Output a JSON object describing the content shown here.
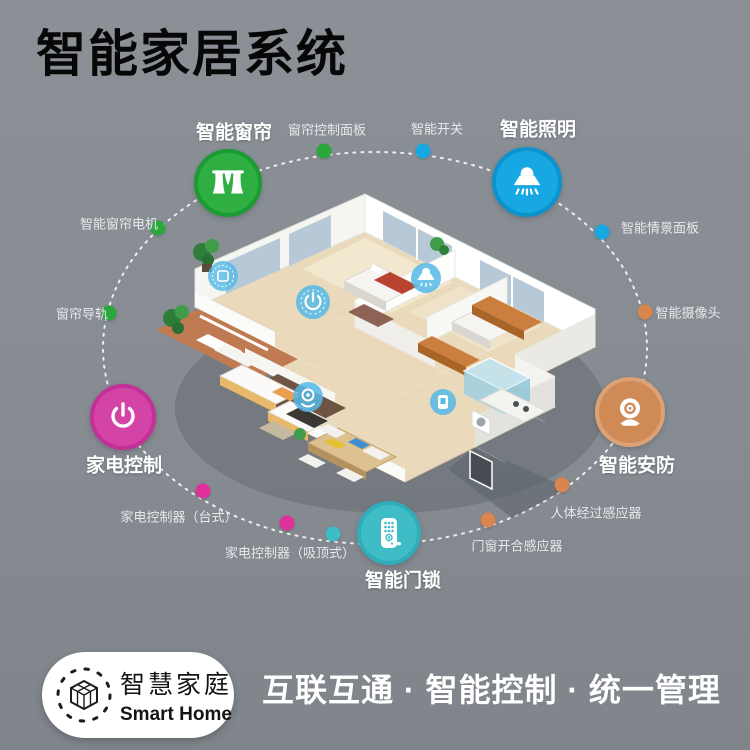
{
  "header": {
    "title": "智能家居系统"
  },
  "colors": {
    "background": "#868c92",
    "green": "#2fae41",
    "blue": "#17a8e4",
    "orange": "#cf8a56",
    "teal": "#3fbdc7",
    "magenta": "#d444a7",
    "dot_orange": "#d8854e",
    "dot_pink": "#e0309c"
  },
  "hubs": [
    {
      "label": "智能窗帘",
      "icon": "curtain-icon",
      "color": "#2fae41"
    },
    {
      "label": "智能照明",
      "icon": "ceiling-lamp-icon",
      "color": "#17a8e4"
    },
    {
      "label": "智能安防",
      "icon": "webcam-icon",
      "color": "#cf8a56"
    },
    {
      "label": "智能门锁",
      "icon": "door-lock-icon",
      "color": "#3fbdc7"
    },
    {
      "label": "家电控制",
      "icon": "power-icon",
      "color": "#d444a7"
    }
  ],
  "nodes": [
    {
      "label": "窗帘控制面板",
      "color": "#2aa83c"
    },
    {
      "label": "智能开关",
      "color": "#17a8e4"
    },
    {
      "label": "智能情景面板",
      "color": "#17a8e4"
    },
    {
      "label": "智能摄像头",
      "color": "#d8854e"
    },
    {
      "label": "人体经过感应器",
      "color": "#d8854e"
    },
    {
      "label": "门窗开合感应器",
      "color": "#d8854e"
    },
    {
      "label": "家电控制器（吸顶式）",
      "color": "#e0309c"
    },
    {
      "label": "家电控制器（台式）",
      "color": "#e0309c"
    },
    {
      "label": "窗帘导轨",
      "color": "#2aa83c"
    },
    {
      "label": "智能窗帘电机",
      "color": "#2aa83c"
    }
  ],
  "floorplan": {
    "markers": [
      "curtain-marker",
      "power-marker",
      "lamp-marker",
      "speaker-marker",
      "panel-marker"
    ]
  },
  "footer": {
    "logo_cn": "智慧家庭",
    "logo_en": "Smart Home",
    "slogan": "互联互通 · 智能控制 · 统一管理"
  }
}
